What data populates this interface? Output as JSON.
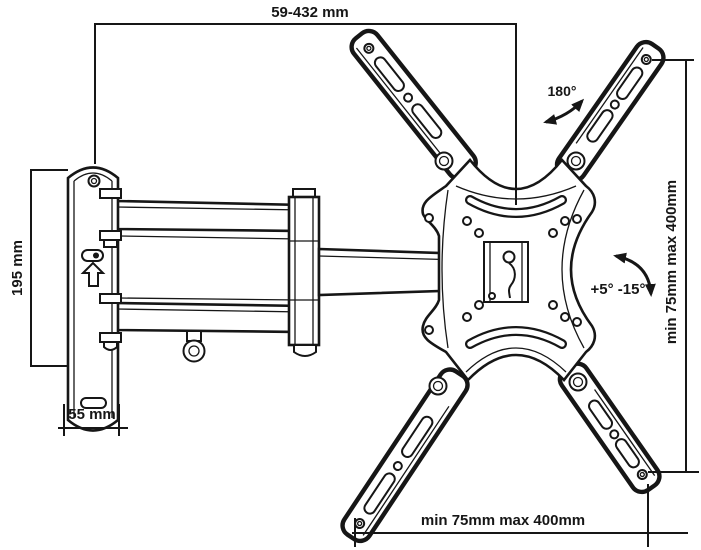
{
  "diagram_type": "wall-mount-bracket-technical-drawing",
  "colors": {
    "line": "#161616",
    "background": "#ffffff"
  },
  "labels": {
    "extension_range": "59-432 mm",
    "plate_height": "195 mm",
    "depth": "55 mm",
    "swivel": "180°",
    "tilt": "+5° -15°",
    "vesa_vertical": "min 75mm max 400mm",
    "vesa_horizontal": "min 75mm max 400mm"
  }
}
